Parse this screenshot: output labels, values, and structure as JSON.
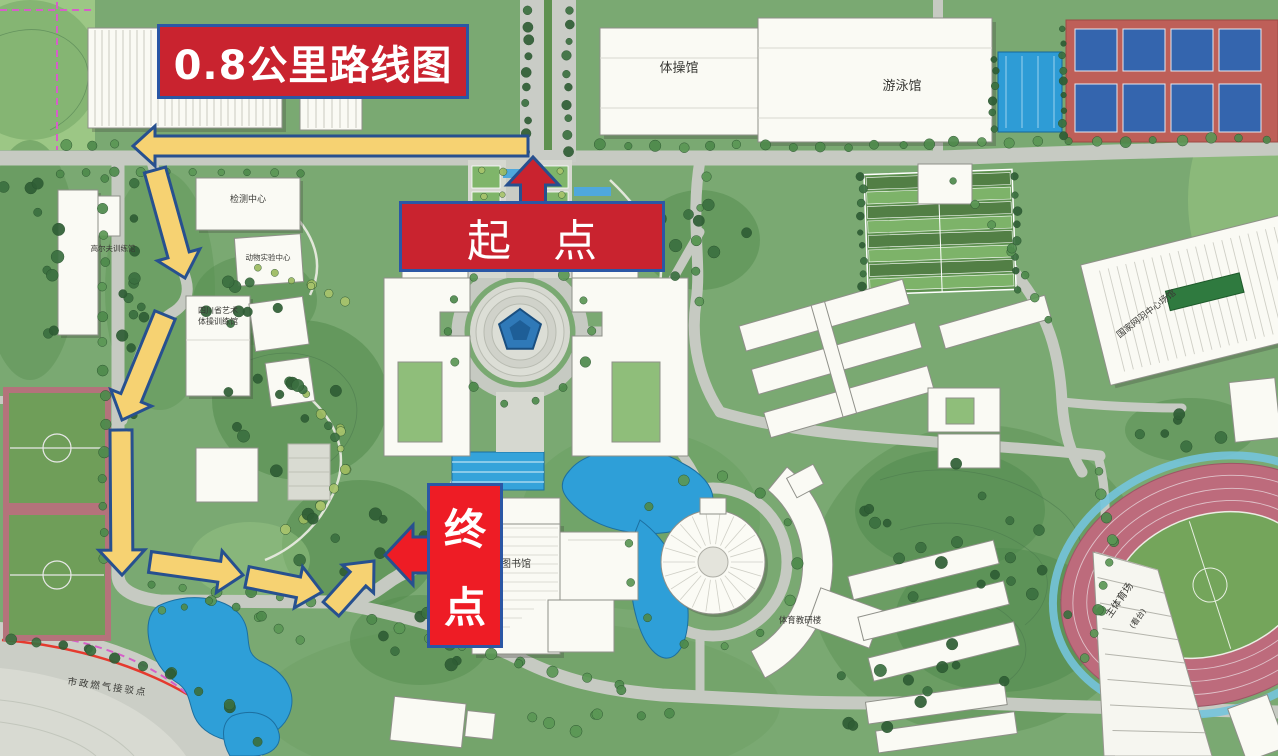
{
  "annotations": {
    "title": {
      "text": "0.8公里路线图",
      "bg": "#C9232F",
      "border": "#2B57A5"
    },
    "start": {
      "text": "起 点",
      "bg": "#C9232F",
      "border": "#2B57A5"
    },
    "end": {
      "text": "终点",
      "top_char": "终",
      "bottom_char": "点",
      "bg": "#EE1C25",
      "border": "#2B57A5"
    }
  },
  "route": {
    "distance_label": "0.8公里",
    "arrow_fill": "#F6D272",
    "arrow_outline": "#27508F",
    "segments": [
      {
        "from": [
          528,
          146
        ],
        "to": [
          133,
          146
        ],
        "sw": 20,
        "hw": 40,
        "hl": 22
      },
      {
        "from": [
          155,
          170
        ],
        "to": [
          185,
          278
        ],
        "sw": 22,
        "hw": 44,
        "hl": 24
      },
      {
        "from": [
          165,
          315
        ],
        "to": [
          122,
          420
        ],
        "sw": 22,
        "hw": 44,
        "hl": 24
      },
      {
        "from": [
          121,
          430
        ],
        "to": [
          122,
          575
        ],
        "sw": 22,
        "hw": 46,
        "hl": 25
      },
      {
        "from": [
          150,
          562
        ],
        "to": [
          243,
          575
        ],
        "sw": 21,
        "hw": 42,
        "hl": 24
      },
      {
        "from": [
          247,
          577
        ],
        "to": [
          322,
          592
        ],
        "sw": 21,
        "hw": 42,
        "hl": 24
      },
      {
        "from": [
          331,
          609
        ],
        "to": [
          374,
          561
        ],
        "sw": 21,
        "hw": 42,
        "hl": 24
      }
    ],
    "start_arrow": {
      "from": [
        533,
        210
      ],
      "to": [
        533,
        157
      ],
      "sw": 25,
      "hw": 52,
      "hl": 28,
      "fill": "#C9232F"
    },
    "end_arrow": {
      "from": [
        468,
        555
      ],
      "to": [
        385,
        555
      ],
      "sw": 36,
      "hw": 60,
      "hl": 28,
      "fill": "#EE1C25"
    }
  },
  "map_labels": [
    {
      "text": "体操馆"
    },
    {
      "text": "游泳馆"
    },
    {
      "text": "检测中心"
    },
    {
      "text": "动物实验中心"
    },
    {
      "text": "四川省艺术"
    },
    {
      "text": "体操训练馆"
    },
    {
      "text": "高尔夫训练馆"
    },
    {
      "text": "图书馆"
    },
    {
      "text": "体育教研楼"
    },
    {
      "text": "主体育场"
    },
    {
      "text": "(看台)"
    },
    {
      "text": "国家网羽中心场馆"
    },
    {
      "text": "市政燃气接驳点"
    }
  ],
  "map_colors": {
    "grass": "#7AA972",
    "forest": "#4F8A4E",
    "road": "#C6CAC2",
    "water": "#2E9FD8",
    "building": "#FAFAF4",
    "track_pink": "#BD6B7C",
    "court_blue": "#3465AE",
    "court_red": "#BE5F58",
    "field_green": "#6F9E59",
    "boundary_magenta": "#D65FC8",
    "gas_line_red": "#E53A2E"
  }
}
